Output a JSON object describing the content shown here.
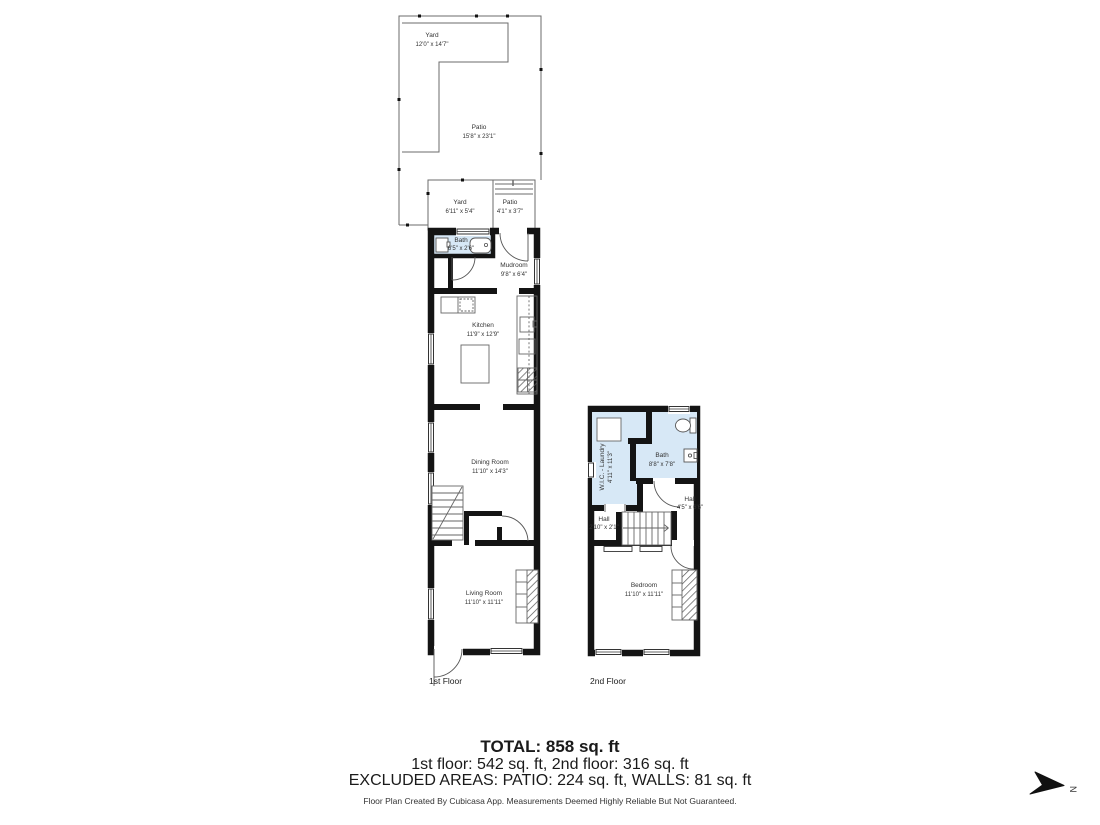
{
  "meta": {
    "wall_color": "#141414",
    "wet_room_fill": "#d7e8f6",
    "thin_line_color": "#5a5a5a",
    "text_color": "#333333"
  },
  "first_floor": {
    "label": "1st Floor",
    "outdoor": {
      "yard_top": {
        "name": "Yard",
        "dims": "12'0\" x 14'7\""
      },
      "patio_top": {
        "name": "Patio",
        "dims": "15'8\" x 23'1\""
      },
      "yard_small": {
        "name": "Yard",
        "dims": "6'11\" x 5'4\""
      },
      "patio_small": {
        "name": "Patio",
        "dims": "4'1\" x 3'7\""
      }
    },
    "rooms": {
      "bath": {
        "name": "Bath",
        "dims": "6'5\" x 2'6\""
      },
      "mudroom": {
        "name": "Mudroom",
        "dims": "9'8\" x 6'4\""
      },
      "kitchen": {
        "name": "Kitchen",
        "dims": "11'9\" x 12'9\""
      },
      "dining": {
        "name": "Dining Room",
        "dims": "11'10\" x 14'3\""
      },
      "living": {
        "name": "Living Room",
        "dims": "11'10\" x 11'11\""
      }
    }
  },
  "second_floor": {
    "label": "2nd Floor",
    "rooms": {
      "wic_laundry": {
        "name": "W.I.C. - Laundry",
        "dims": "4'11\" x 11'3\""
      },
      "bath": {
        "name": "Bath",
        "dims": "8'8\" x 7'8\""
      },
      "hall_right": {
        "name": "Hall",
        "dims": "4'5\" x 6'6\""
      },
      "hall_left": {
        "name": "Hall",
        "dims": "2'10\" x 2'1\""
      },
      "bedroom": {
        "name": "Bedroom",
        "dims": "11'10\" x 11'11\""
      }
    }
  },
  "summary": {
    "total": "TOTAL: 858 sq. ft",
    "floors": "1st floor: 542 sq. ft, 2nd floor: 316 sq. ft",
    "excluded": "EXCLUDED AREAS: PATIO: 224 sq. ft, WALLS: 81 sq. ft"
  },
  "footer": "Floor Plan Created By Cubicasa App. Measurements Deemed Highly Reliable But Not Guaranteed.",
  "compass": {
    "label": "N"
  }
}
